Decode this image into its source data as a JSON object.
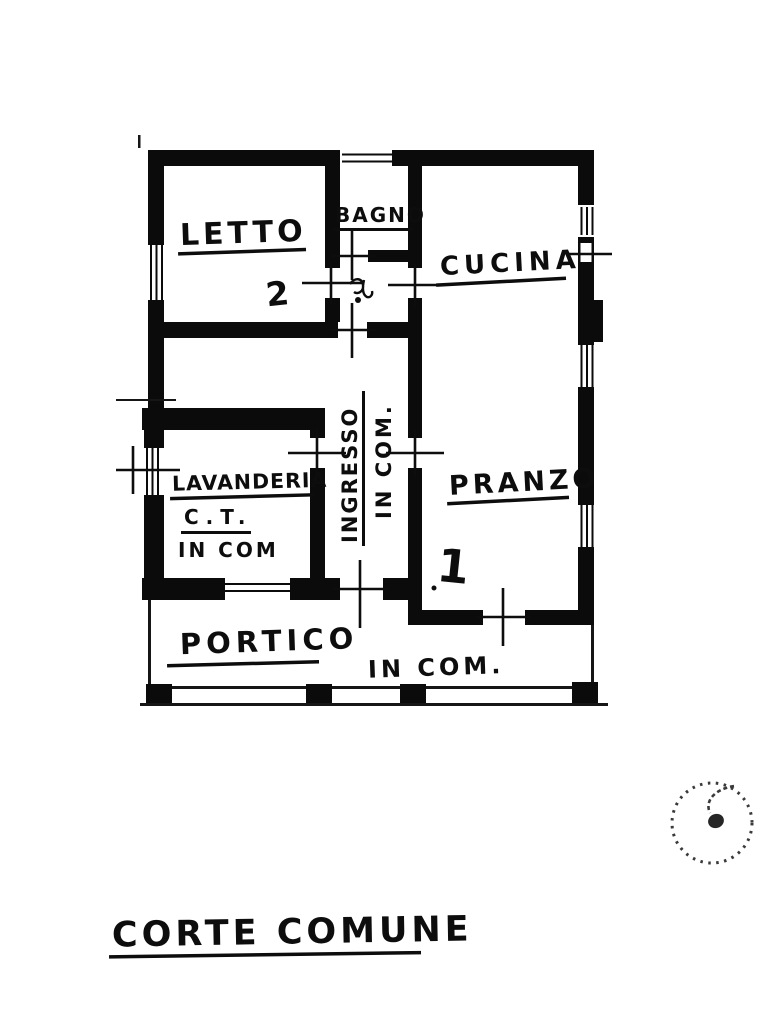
{
  "plan": {
    "rooms": {
      "letto": {
        "label": "LETTO",
        "number": "2"
      },
      "bagno": {
        "label": "BAGNO"
      },
      "cucina": {
        "label": "CUCINA"
      },
      "pranzo": {
        "label": "PRANZO",
        "number": "1"
      },
      "lavanderia": {
        "label": "LAVANDERIA",
        "subtitle": "C.T.",
        "note": "IN COM"
      },
      "ingresso": {
        "label": "INGRESSO",
        "note": "IN COM."
      },
      "portico": {
        "label": "PORTICO",
        "note": "IN COM."
      }
    },
    "caption": "CORTE COMUNE",
    "ink_color": "#0d0d0d"
  }
}
